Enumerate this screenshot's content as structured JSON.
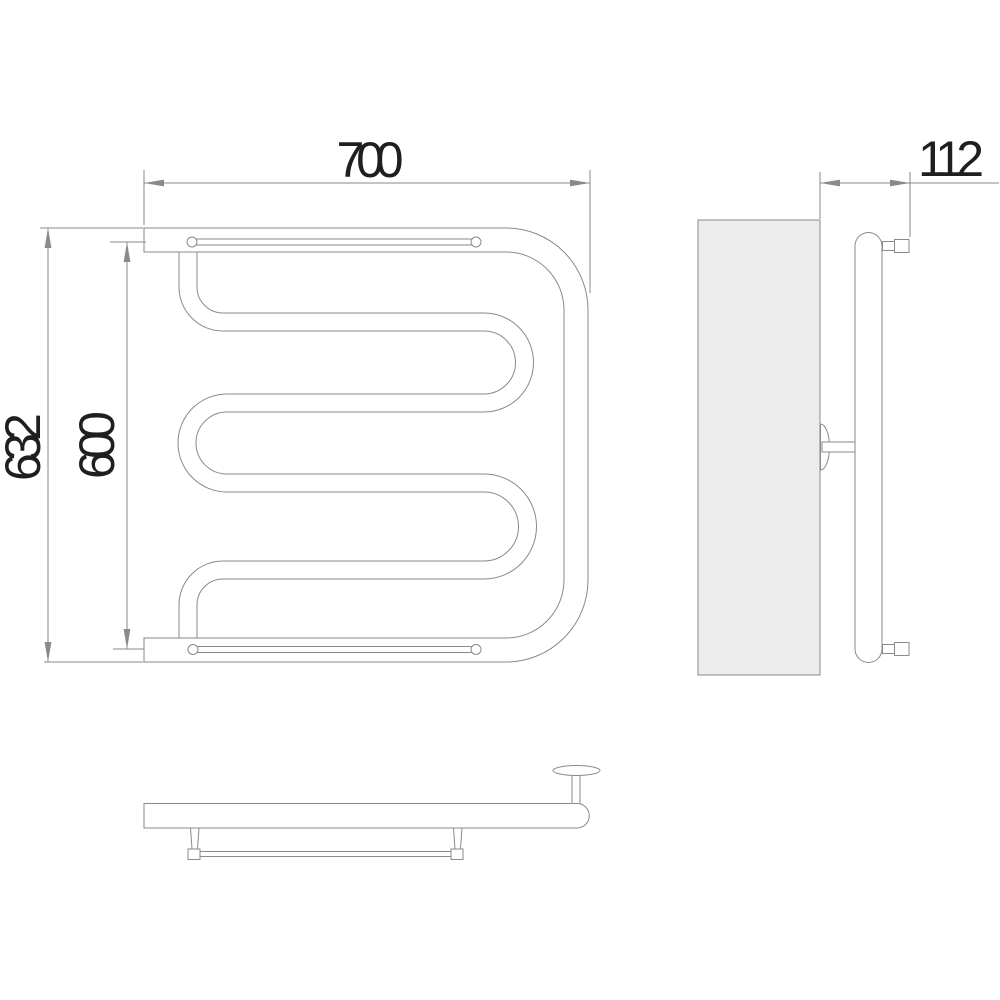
{
  "drawing": {
    "type": "technical-dimension-drawing",
    "views": {
      "front": {
        "dim_width": "700",
        "dim_height_overall": "632",
        "dim_rail_spacing": "600"
      },
      "side": {
        "dim_depth": "112"
      }
    },
    "colors": {
      "line": "#8a8a8a",
      "label_text": "#1f1f1f",
      "wall_fill": "#ececec",
      "background": "#ffffff"
    }
  }
}
